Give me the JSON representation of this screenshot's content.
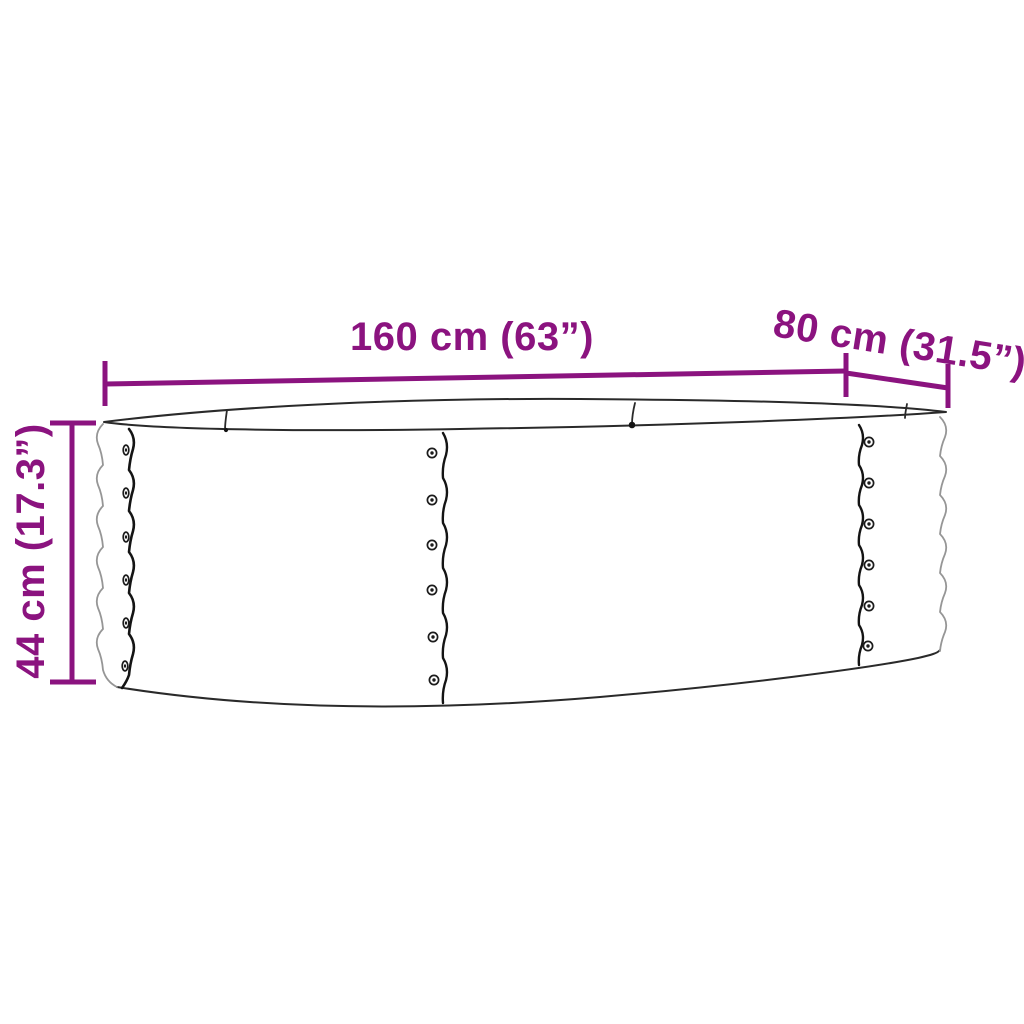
{
  "diagram": {
    "illustration": "oval-raised-garden-bed-line-art",
    "dimensions": {
      "length": "160 cm (63”)",
      "depth": "80 cm (31.5”)",
      "height": "44 cm (17.3”)"
    },
    "colors": {
      "dimension_accent": "#8B137F",
      "outline_dark": "#1c1c1c",
      "outline_light": "#969696",
      "background": "#FFFFFF"
    }
  }
}
